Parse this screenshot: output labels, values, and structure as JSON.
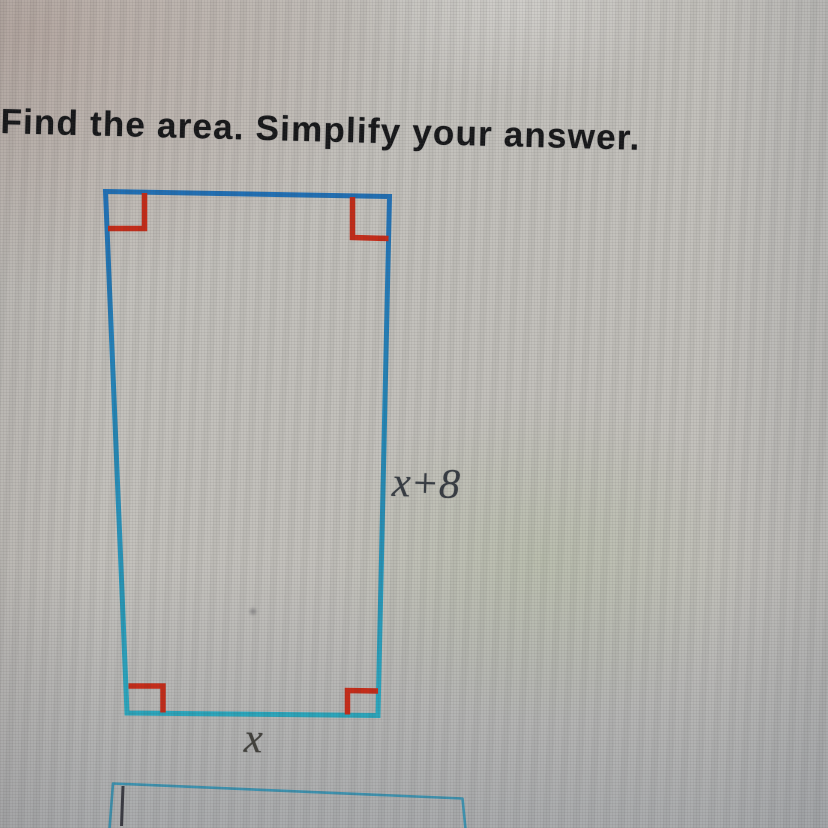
{
  "problem": {
    "title": "Find the area. Simplify your answer."
  },
  "figure": {
    "shape": "rectangle",
    "height_label": "x+8",
    "width_label": "x",
    "edge_color_top": "#2170b5",
    "edge_color_bottom": "#2ba6bc",
    "right_angle_color": "#c72c19",
    "label_color": "#383d44"
  },
  "answer_input": {
    "value": "",
    "placeholder": "",
    "border_color": "#3e93b0",
    "cursor_color": "#3a3a42"
  }
}
